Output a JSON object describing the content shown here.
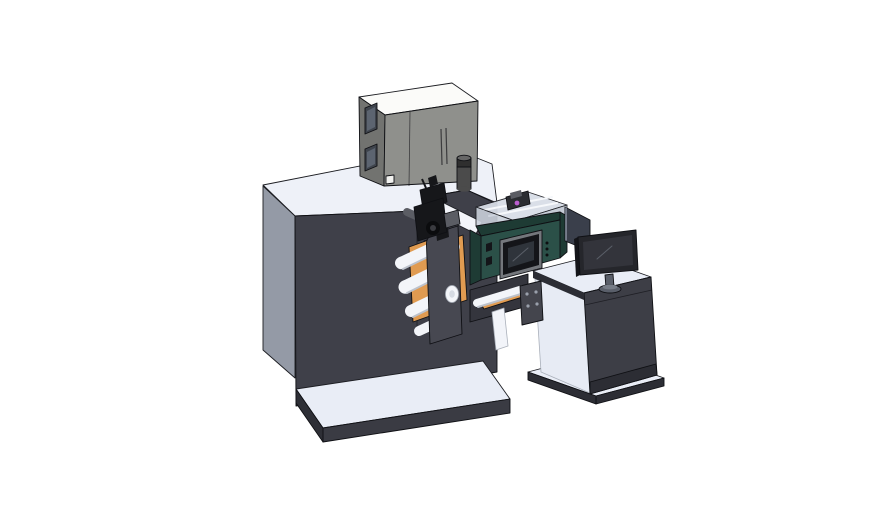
{
  "canvas": {
    "width": 888,
    "height": 522,
    "background": "#ffffff"
  },
  "scene": {
    "type": "3d-cad-render",
    "parts": [
      {
        "id": "machine-body",
        "label": "Main machine body"
      },
      {
        "id": "machine-base-plate",
        "label": "Machine base plate"
      },
      {
        "id": "dryer-cabinet",
        "label": "Gray equipment cabinet"
      },
      {
        "id": "exhaust-muffler",
        "label": "Exhaust cylinder"
      },
      {
        "id": "web-plate",
        "label": "Angled web guide plate"
      },
      {
        "id": "print-engine",
        "label": "Print engine with ink tray"
      },
      {
        "id": "hmi-screen",
        "label": "HMI control screen"
      },
      {
        "id": "unwind-station",
        "label": "Unwind station with rollers"
      },
      {
        "id": "web-guide-mechanism",
        "label": "Black web guide mechanism"
      },
      {
        "id": "auxiliary-panel",
        "label": "Auxiliary display panel"
      },
      {
        "id": "control-desk",
        "label": "Operator desk"
      },
      {
        "id": "desk-base-plate",
        "label": "Desk base plate"
      },
      {
        "id": "mounting-bracket",
        "label": "Mounting bracket with holes"
      },
      {
        "id": "operator-monitor",
        "label": "Desktop monitor on stand"
      }
    ]
  },
  "colors": {
    "bg": "#ffffff",
    "outline": "#1c1d22",
    "outlineDark": "#0f1014",
    "outlineLight": "#aab0ba",
    "topWhite": "#eef1f8",
    "bodySide": "#949aa6",
    "bodyDark": "#3f4049",
    "bodyDarker": "#34353d",
    "platformTop": "#e9edf6",
    "platformSkirt": "#3a3b43",
    "platformSkirtDark": "#2e2f36",
    "cabinetTop": "#fbfbf9",
    "cabinetFront": "#8f908c",
    "cabinetSide": "#727370",
    "cabinetWindow": "#3f444c",
    "cabinetWindowInner": "#5c6470",
    "cabinetSquare": "#f2f2ef",
    "muffler": "#4b4b4b",
    "mufflerDark": "#2f2f2f",
    "mufflerTop": "#666666",
    "webWhite": "#f2f4f9",
    "roller": "#f3f5f9",
    "rollerShade": "#bcc2cc",
    "rollerEnd": "#d6dbe3",
    "orange": "#e09b51",
    "coverPlate": "#474851",
    "mechBlack": "#16171a",
    "mechGray": "#5b5d64",
    "knobDark": "#0b0c0e",
    "knobInner": "#3a3b40",
    "trayGlass": "#d8dee7",
    "trayGlassSide": "#c9d0da",
    "trayGlassSide2": "#bfc6d1",
    "rail": "#f6f8fb",
    "carriage": "#2b2d32",
    "magenta": "#bb5ed0",
    "teal": "#2b5048",
    "tealDark": "#1e3b34",
    "screenFrame": "#74777c",
    "screenBezel": "#141519",
    "screenInner": "#2f343b",
    "glare": "#5a5f68",
    "buttonDot": "#0d0e10",
    "panelDark": "#3a3f4b",
    "edgeHighlight": "#8a92a2",
    "deskTop": "#e9edf6",
    "deskFront": "#3d3e46",
    "deskSide": "#2c2d34",
    "deskInner": "#e7ebf4",
    "bracketGray": "#44454d",
    "holeDot": "#9aa0ab",
    "monitorBezel": "#25262b",
    "monitorScreen": "#33343b",
    "standGray": "#5a5f6a",
    "standTop": "#767c87"
  }
}
